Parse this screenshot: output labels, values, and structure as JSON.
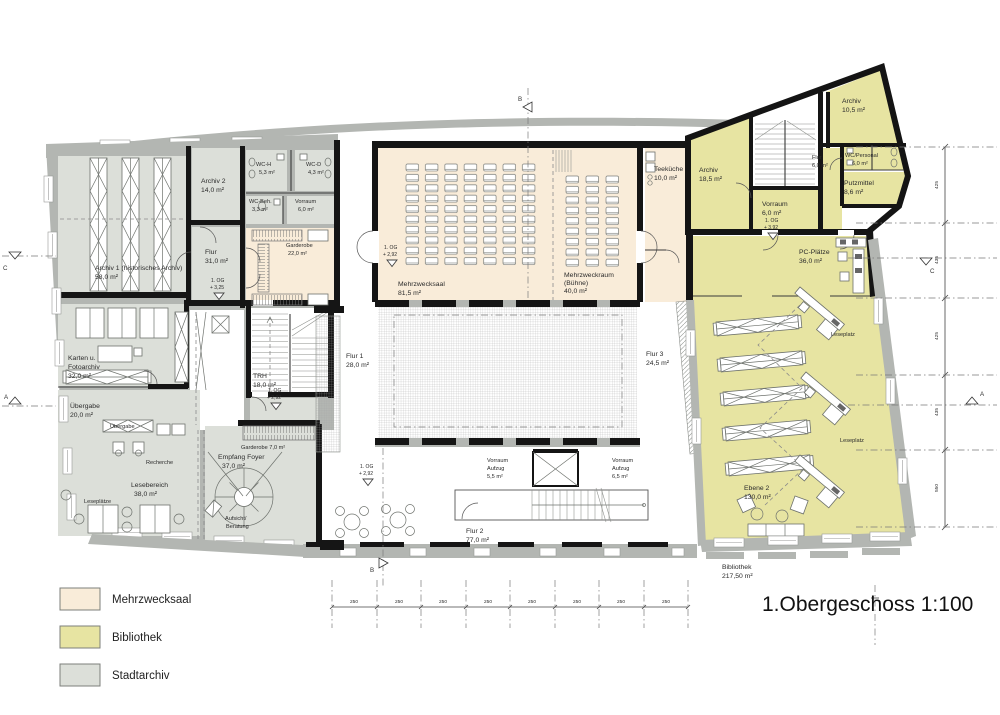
{
  "title": "1.Obergeschoss 1:100",
  "legend": [
    {
      "label": "Mehrzwecksaal",
      "color": "#f9ecd9"
    },
    {
      "label": "Bibliothek",
      "color": "#e7e4a2"
    },
    {
      "label": "Stadtarchiv",
      "color": "#dcdfd9"
    }
  ],
  "rooms": {
    "archiv1": {
      "name": "Archiv 1 (historisches Archiv)",
      "area": "58,0 m²"
    },
    "archiv2": {
      "name": "Archiv 2",
      "area": "14,0 m²"
    },
    "wc_h": {
      "name": "WC-H",
      "area": "5,3 m²"
    },
    "wc_d": {
      "name": "WC-D",
      "area": "4,3 m²"
    },
    "wc_beh": {
      "name": "WC-Beh.",
      "area": "3,3 m²"
    },
    "vorraum_wc": {
      "name": "Vorraum",
      "area": "6,0 m²"
    },
    "flur_archiv": {
      "name": "Flur",
      "area": "31,0 m²"
    },
    "garderobe": {
      "name": "Garderobe",
      "area": "22,0 m²"
    },
    "karten": {
      "name": "Karten u.",
      "name2": "Fotoarchiv",
      "area": "32,0 m²"
    },
    "uebergabe": {
      "name": "Übergabe",
      "area": "20,0 m²"
    },
    "lesebereich": {
      "name": "Lesebereich",
      "area": "38,0 m²"
    },
    "trh": {
      "name": "TRH",
      "area": "18,0 m²"
    },
    "garderobe_foyer": {
      "name": "Garderobe 7,0 m²"
    },
    "empfang": {
      "name": "Empfang Foyer",
      "area": "37,0 m²"
    },
    "mehrzwecksaal": {
      "name": "Mehrzwecksaal",
      "area": "81,5 m²"
    },
    "mehrzweckraum": {
      "name": "Mehrzweckraum",
      "name2": "(Bühne)",
      "area": "40,0 m²"
    },
    "teekueche": {
      "name": "Teeküche",
      "area": "10,0 m²"
    },
    "flur1": {
      "name": "Flur 1",
      "area": "28,0 m²"
    },
    "flur2": {
      "name": "Flur 2",
      "area": "77,0 m²"
    },
    "flur3": {
      "name": "Flur 3",
      "area": "24,5 m²"
    },
    "vorraum_aufzug1": {
      "name": "Vorraum",
      "name2": "Aufzug",
      "area": "5,5 m²"
    },
    "vorraum_aufzug2": {
      "name": "Vorraum",
      "name2": "Aufzug",
      "area": "6,5 m²"
    },
    "archiv_bib": {
      "name": "Archiv",
      "area": "18,5 m²"
    },
    "archiv_bib2": {
      "name": "Archiv",
      "area": "10,5 m²"
    },
    "flur_bib": {
      "name": "Flur",
      "area": "6,0 m²"
    },
    "wc_personal": {
      "name": "WC/Personal",
      "area": "6,0 m²"
    },
    "putzmittel": {
      "name": "Putzmittel",
      "area": "8,6 m²"
    },
    "vorraum_bib": {
      "name": "Vorraum",
      "area": "6,0 m²"
    },
    "pc_plaetze": {
      "name": "PC-Plätze",
      "area": "36,0 m²"
    },
    "ebene2": {
      "name": "Ebene 2",
      "area": "130,0 m²"
    },
    "bibliothek": {
      "name": "Bibliothek",
      "area": "217,50 m²"
    }
  },
  "annotations": {
    "leseplaetze": "Leseplätze",
    "leseplatz": "Leseplatz",
    "recherche": "Recherche",
    "uebergabe_desk": "Übergabe",
    "aufsicht1": "Aufsicht/",
    "aufsicht2": "Beratung"
  },
  "levels": {
    "og325": {
      "floor": "1. OG",
      "value": "+ 3,25"
    },
    "og292": {
      "floor": "1. OG",
      "value": "+ 2,92"
    },
    "og392": {
      "floor": "1. OG",
      "value": "+ 3,92"
    }
  },
  "sections": {
    "a": "A",
    "b": "B",
    "c": "C"
  },
  "dimensions": {
    "bottom": [
      "250",
      "250",
      "250",
      "250",
      "250",
      "250",
      "250",
      "250"
    ],
    "right": [
      "425",
      "435",
      "425",
      "435",
      "550"
    ]
  }
}
